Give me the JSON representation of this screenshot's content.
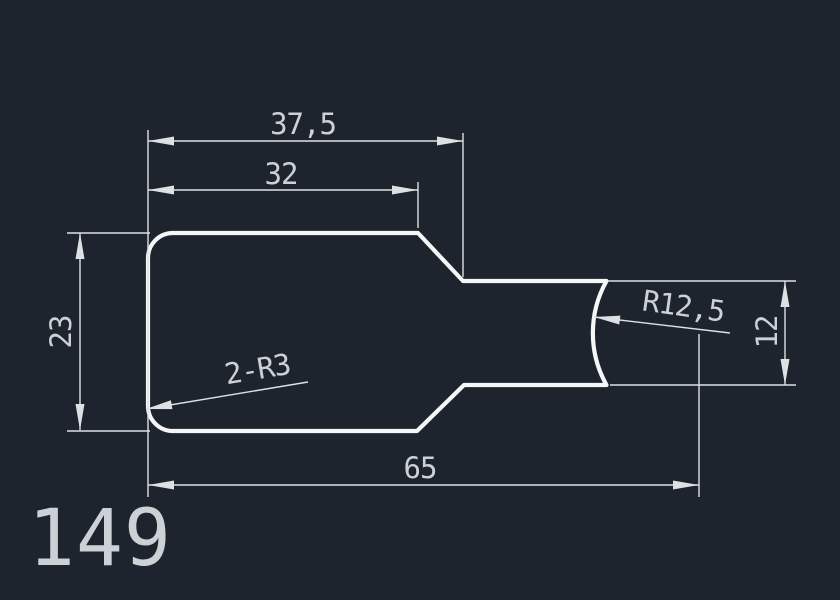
{
  "colors": {
    "background": "#1e242d",
    "outline": "#f4f6f7",
    "dim": "#dde1e4",
    "text": "#ccd1d5"
  },
  "part_number": "149",
  "dimensions": {
    "top_width": "37,5",
    "step_width": "32",
    "left_height": "23",
    "right_height": "12",
    "total_length": "65",
    "end_radius": "R12,5",
    "fillet_note": "2-R3"
  }
}
